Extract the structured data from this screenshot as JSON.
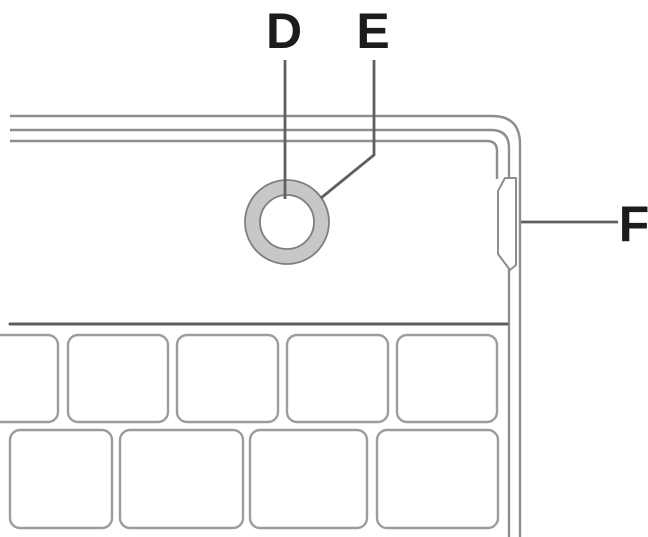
{
  "callouts": {
    "d": {
      "label": "D"
    },
    "e": {
      "label": "E"
    },
    "f": {
      "label": "F"
    }
  },
  "colors": {
    "background": "#ffffff",
    "edge_line": "#8e8e8e",
    "separator_line": "#5c5c5c",
    "leader_line": "#5f5f5f",
    "label_text": "#1c1c1c",
    "ring_fill": "#c7c7c7",
    "ring_stroke": "#7e7e7e",
    "button_face": "#ffffff",
    "key_stroke": "#9c9c9c",
    "key_face": "#ffffff"
  }
}
